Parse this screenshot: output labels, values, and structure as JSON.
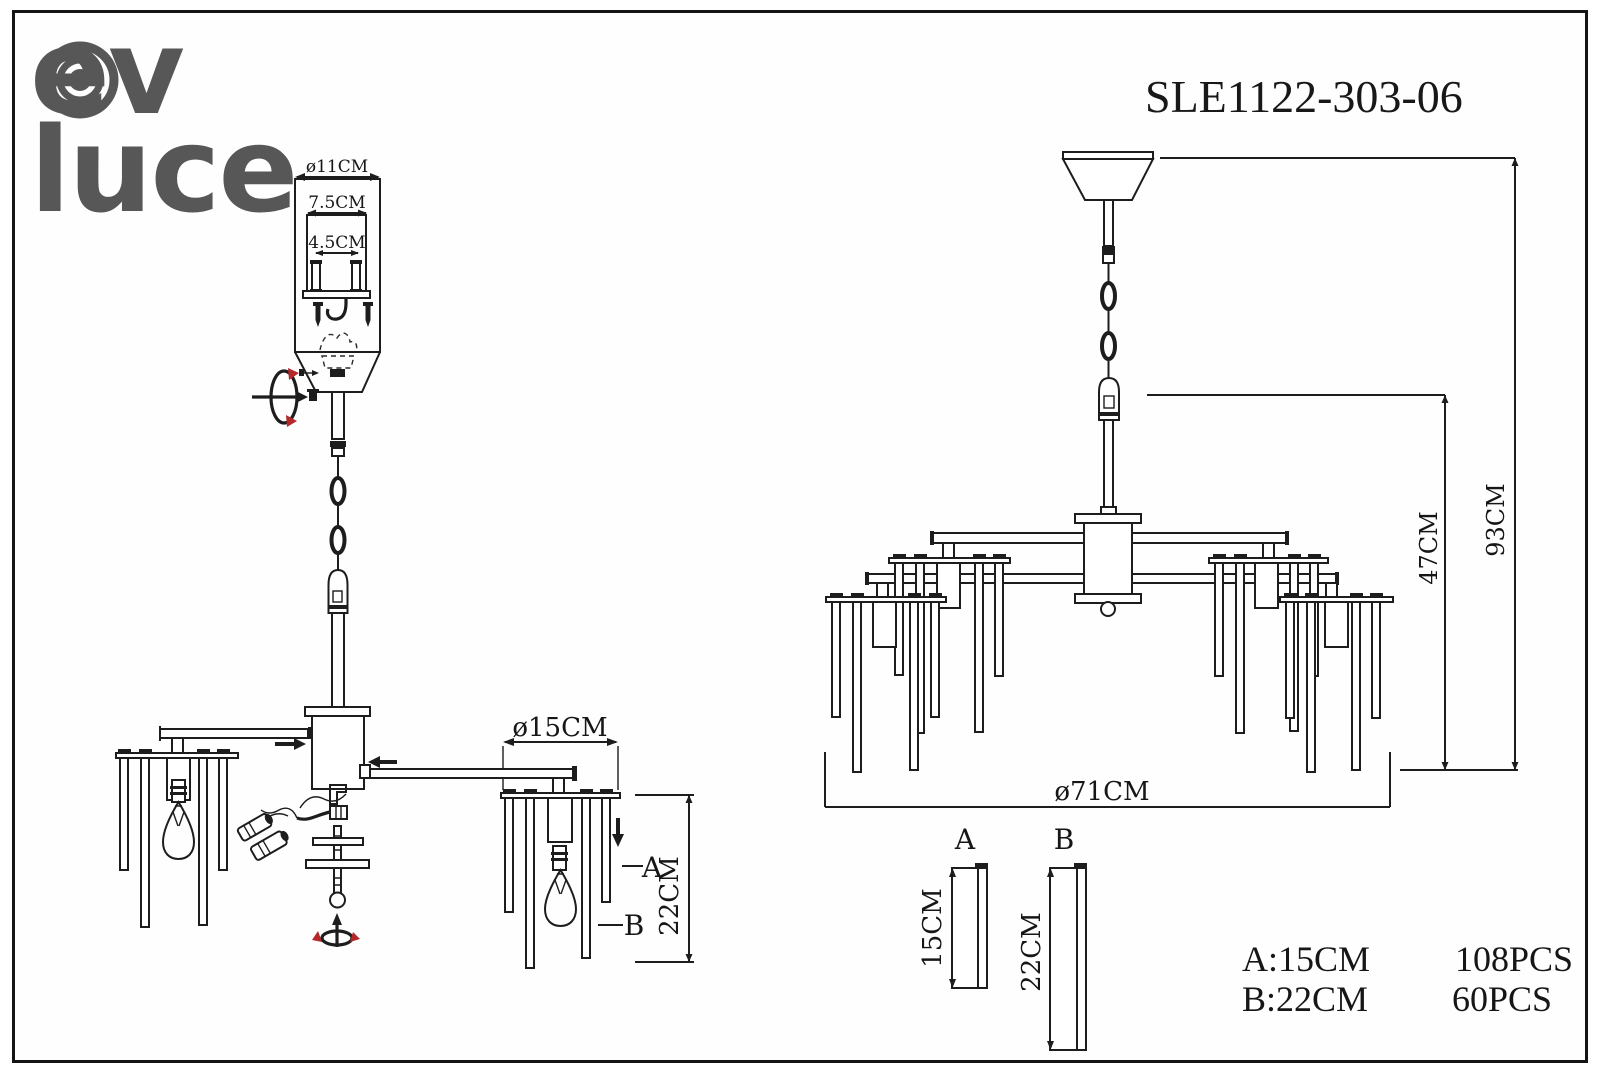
{
  "brand": {
    "line1": "ev",
    "line2": "luce"
  },
  "model": "SLE1122-303-06",
  "exploded_view": {
    "canopy_diameter": "ø11CM",
    "bracket_width": "7.5CM",
    "screw_spacing": "4.5CM",
    "disc_diameter": "ø15CM",
    "rod_length_b": "22CM",
    "label_a": "A",
    "label_b": "B"
  },
  "assembled_view": {
    "body_height": "47CM",
    "total_height": "93CM",
    "diameter": "ø71CM"
  },
  "parts": {
    "a_label": "A",
    "a_length": "15CM",
    "b_label": "B",
    "b_length": "22CM"
  },
  "legend": {
    "a_spec": "A:15CM",
    "a_qty": "108PCS",
    "b_spec": "B:22CM",
    "b_qty": "60PCS"
  },
  "colors": {
    "line": "#1d1d1d",
    "accent_red": "#b5282a",
    "logo_gray": "#575757",
    "paper": "#fefefe"
  }
}
